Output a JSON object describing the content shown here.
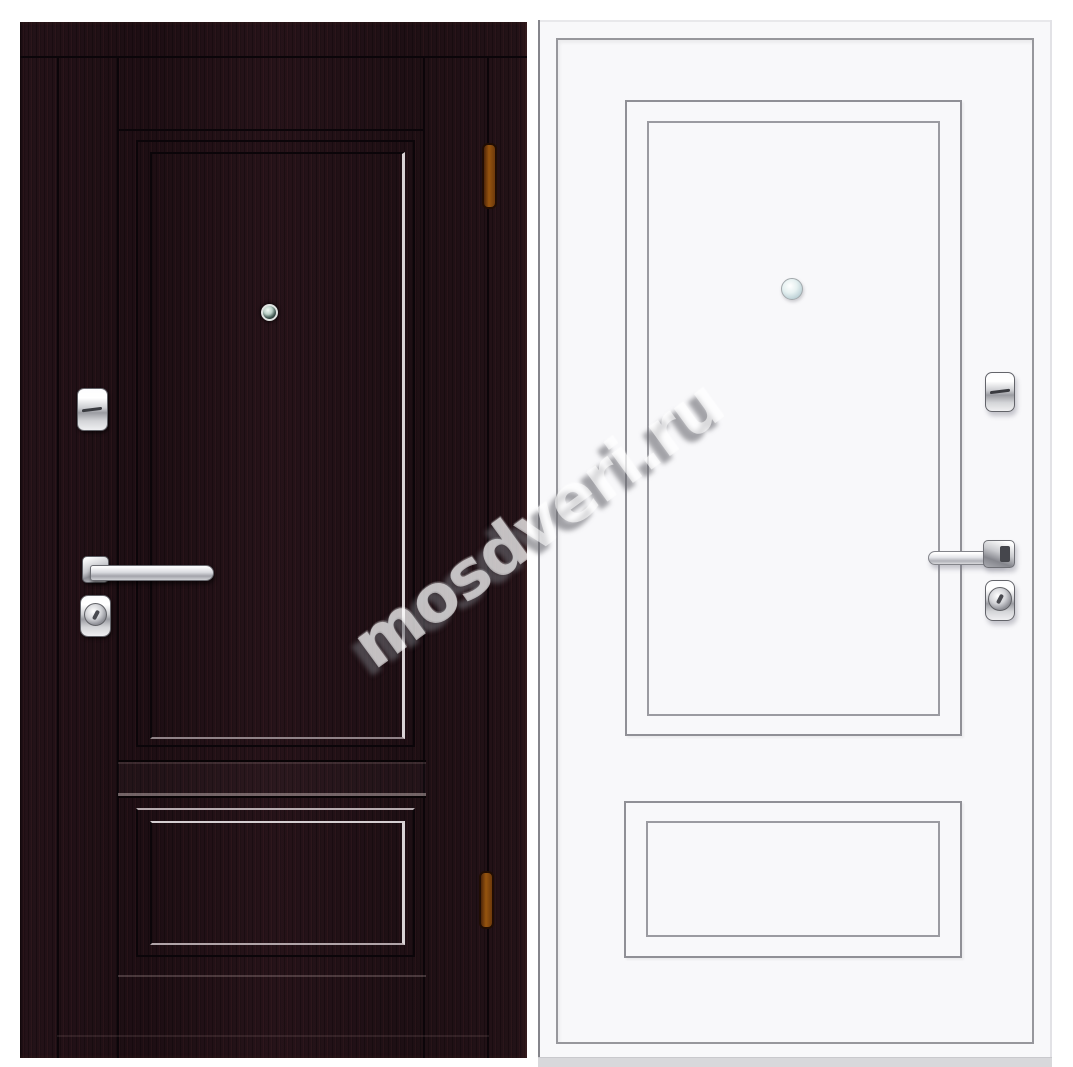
{
  "watermark": {
    "text": "mosdveri.ru"
  },
  "colors": {
    "page_bg": "#ffffff",
    "wenge_base": "#221117",
    "wenge_dark_line": "#0b0509",
    "molding_highlight": "#d8d3d5",
    "white_door_face": "#f8f8fa",
    "gray_line": "#97979c",
    "hinge_amber": "#96540f",
    "chrome_light": "#fcfcfd",
    "chrome_mid": "#babbc1",
    "chrome_dark": "#84858c"
  },
  "doors": {
    "left": {
      "hardware": [
        "deadbolt-escutcheon",
        "peephole",
        "lever-handle",
        "cylinder-lock",
        "hinge",
        "hinge"
      ]
    },
    "right": {
      "hardware": [
        "thumbturn-escutcheon",
        "peephole",
        "lever-handle",
        "cylinder-lock"
      ]
    }
  }
}
